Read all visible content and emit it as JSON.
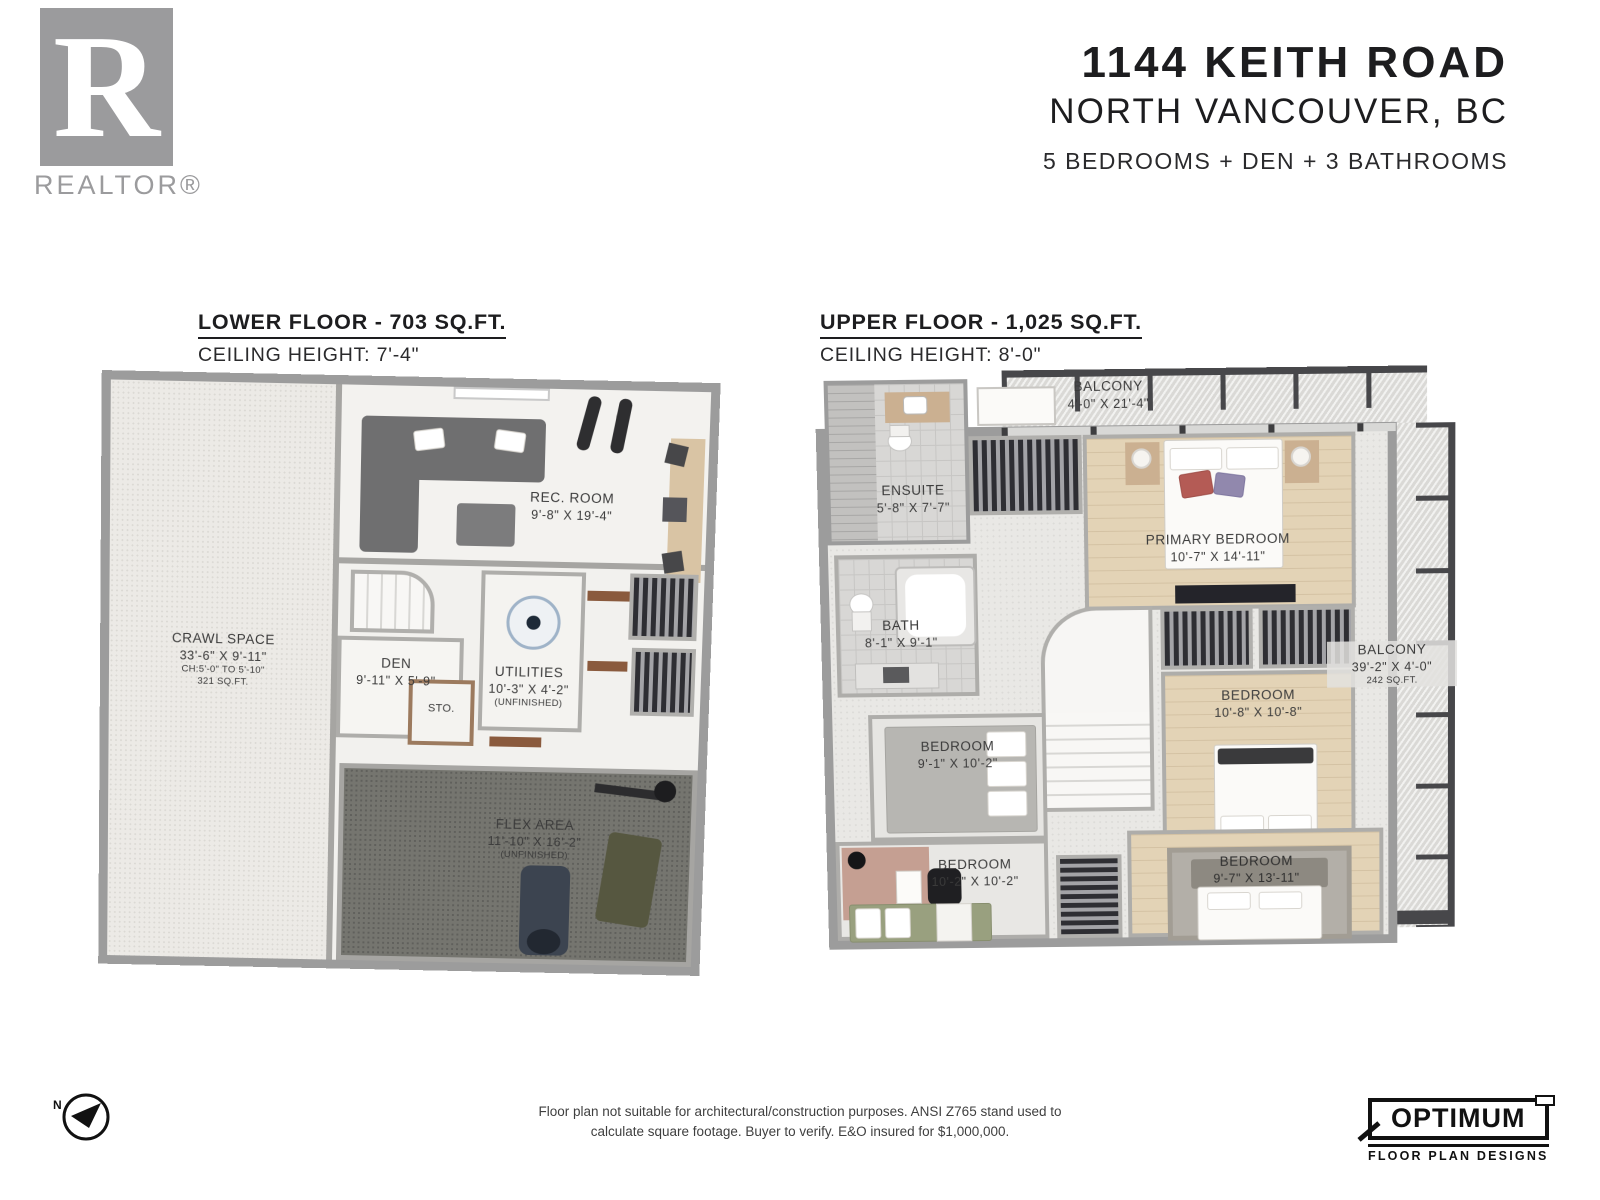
{
  "branding": {
    "realtor_r": "R",
    "realtor_label": "REALTOR®",
    "compass_label": "N",
    "optimum_title": "OPTIMUM",
    "optimum_subtitle": "FLOOR PLAN DESIGNS"
  },
  "header": {
    "address": "1144 KEITH ROAD",
    "city": "NORTH VANCOUVER, BC",
    "summary": "5 BEDROOMS + DEN + 3 BATHROOMS"
  },
  "lower_floor": {
    "title": "LOWER FLOOR - 703 SQ.FT.",
    "ceiling": "CEILING HEIGHT: 7'-4\"",
    "rooms": [
      {
        "name": "CRAWL SPACE",
        "dims": "33'-6\" X 9'-11\"",
        "note1": "CH:5'-0\" TO 5'-10\"",
        "note2": "321 SQ.FT."
      },
      {
        "name": "REC. ROOM",
        "dims": "9'-8\" X 19'-4\""
      },
      {
        "name": "DEN",
        "dims": "9'-11\" X 5'-9\""
      },
      {
        "name": "UTILITIES",
        "dims": "10'-3\" X 4'-2\"",
        "note1": "(UNFINISHED)"
      },
      {
        "name": "STO."
      },
      {
        "name": "FLEX AREA",
        "dims": "11'-10\" X 16'-2\"",
        "note1": "(UNFINISHED)"
      }
    ]
  },
  "upper_floor": {
    "title": "UPPER FLOOR - 1,025 SQ.FT.",
    "ceiling": "CEILING HEIGHT: 8'-0\"",
    "rooms": [
      {
        "name": "BALCONY",
        "dims": "4'-0\" X 21'-4\""
      },
      {
        "name": "ENSUITE",
        "dims": "5'-8\" X 7'-7\""
      },
      {
        "name": "PRIMARY BEDROOM",
        "dims": "10'-7\" X 14'-11\""
      },
      {
        "name": "BATH",
        "dims": "8'-1\" X 9'-1\""
      },
      {
        "name": "BEDROOM",
        "dims": "10'-8\" X 10'-8\""
      },
      {
        "name": "BALCONY",
        "dims": "39'-2\" X 4'-0\"",
        "note1": "242 SQ.FT."
      },
      {
        "name": "BEDROOM",
        "dims": "9'-1\" X 10'-2\""
      },
      {
        "name": "BEDROOM",
        "dims": "10'-2\" X 10'-2\""
      },
      {
        "name": "BEDROOM",
        "dims": "9'-7\" X 13'-11\""
      }
    ]
  },
  "footer": {
    "disclaimer_line1": "Floor plan not suitable for architectural/construction purposes. ANSI Z765 stand used to",
    "disclaimer_line2": "calculate square footage. Buyer to verify.  E&O insured for $1,000,000."
  }
}
